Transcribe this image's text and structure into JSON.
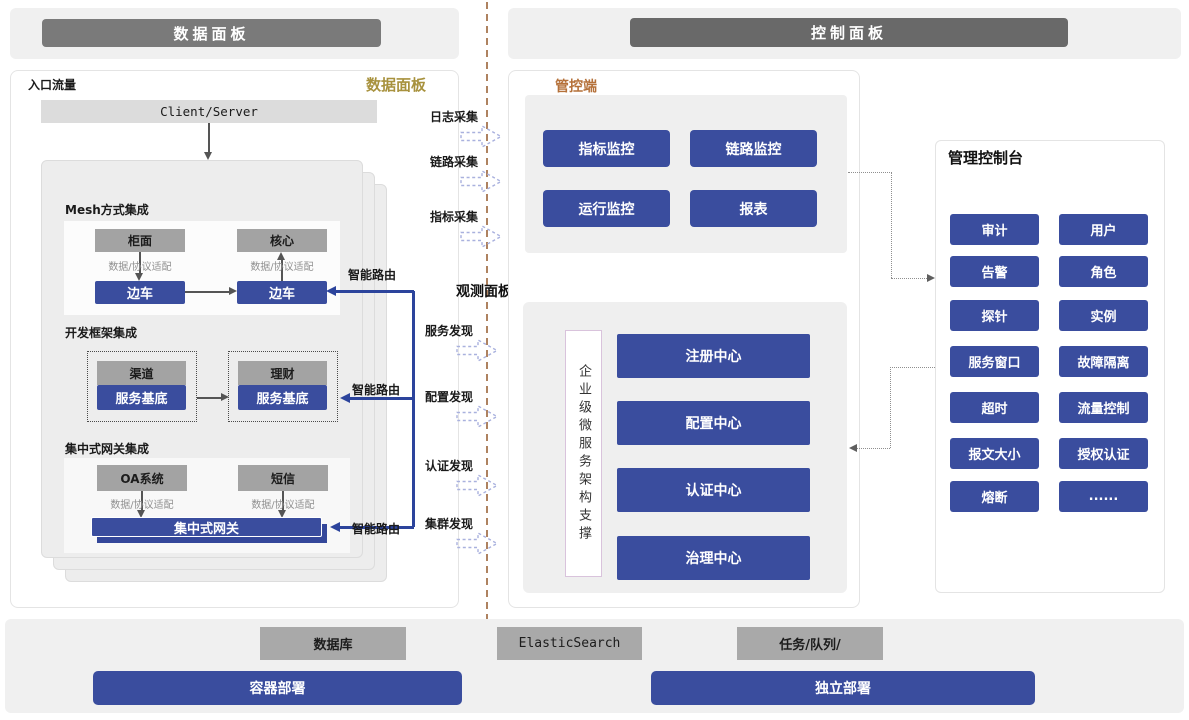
{
  "banners": {
    "data_plane": "数据面板",
    "control_plane": "控制面板"
  },
  "data_panel": {
    "entry_label": "入口流量",
    "panel_tag": "数据面板",
    "client_server": "Client/Server",
    "mesh": {
      "title": "Mesh方式集成",
      "top_left": "柜面",
      "top_right": "核心",
      "adapter_left": "数据/协议适配",
      "adapter_right": "数据/协议适配",
      "sidecar_left": "边车",
      "sidecar_right": "边车",
      "route": "智能路由"
    },
    "framework": {
      "title": "开发框架集成",
      "top_left": "渠道",
      "top_right": "理财",
      "base_left": "服务基底",
      "base_right": "服务基底",
      "route": "智能路由"
    },
    "gateway": {
      "title": "集中式网关集成",
      "top_left": "OA系统",
      "top_right": "短信",
      "adapter_left": "数据/协议适配",
      "adapter_right": "数据/协议适配",
      "bar": "集中式网关",
      "route": "智能路由"
    }
  },
  "flows": {
    "collect": [
      "日志采集",
      "链路采集",
      "指标采集"
    ],
    "observe_title": "观测面板",
    "discover": [
      "服务发现",
      "配置发现",
      "认证发现",
      "集群发现"
    ]
  },
  "control": {
    "tag": "管控端",
    "monitors": [
      "指标监控",
      "链路监控",
      "运行监控",
      "报表"
    ],
    "support_label": "企业级微服务架构支撑",
    "centers": [
      "注册中心",
      "配置中心",
      "认证中心",
      "治理中心"
    ]
  },
  "console": {
    "title": "管理控制台",
    "buttons": [
      "审计",
      "用户",
      "告警",
      "角色",
      "探针",
      "实例",
      "服务窗口",
      "故障隔离",
      "超时",
      "流量控制",
      "报文大小",
      "授权认证",
      "熔断",
      "......"
    ]
  },
  "infra": {
    "database": "数据库",
    "elastic": "ElasticSearch",
    "queue": "任务/队列/",
    "container_deploy": "容器部署",
    "standalone_deploy": "独立部署"
  },
  "colors": {
    "primary_blue": "#3a4d9e",
    "banner_gray": "#7a7a7a",
    "accent_gold": "#a8923e",
    "accent_orange": "#b5713a",
    "divider_tan": "#ae8260"
  }
}
